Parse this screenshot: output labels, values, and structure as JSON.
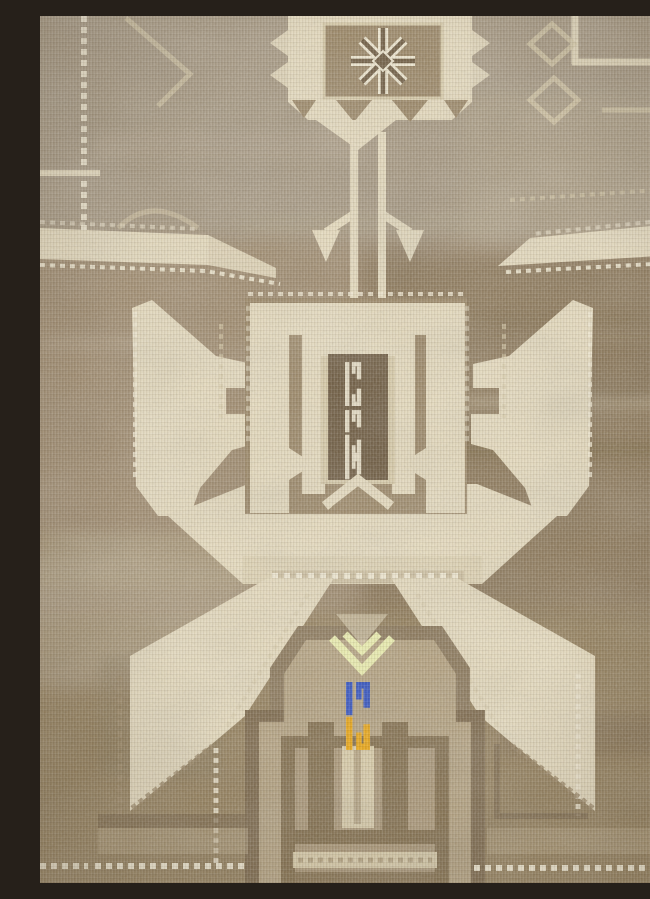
{
  "photo": {
    "type": "photograph",
    "subject": "Vintage hand-knotted Anatolian (Kars) carpet fragment with faded geometric design",
    "alt": "Close-up of a faded beige and brown Anatolian carpet: a square panel with an eight-point snowflake star at top, a pendant stem with two anchor hooks, a large ivory hooked X-shaped medallion with a dark ladder column at center, and a stepped nested-box medallion below with small cobalt-blue, amber and chartreuse knots",
    "visible_text": "none"
  },
  "palette": {
    "field-top": "#a99b84",
    "field-mid": "#a28e71",
    "field-right": "#907c5d",
    "field-bottom": "#97835f",
    "tan-light": "#b9ab90",
    "tan-mid": "#b5a381",
    "tan-mid2": "#ab9878",
    "cream": "#e7dcbe",
    "cream-dim": "#d9cca9",
    "ivory": "#f2ead2",
    "brown-mid": "#9d8968",
    "brown-mid2": "#8d7a5c",
    "brown-dark": "#7e6a4c",
    "brown-dark2": "#84704e",
    "brown-deep": "#6f5c41",
    "accent-blue": "#2d4fc3",
    "accent-gold": "#eca712",
    "accent-chartreuse": "#ecefae"
  },
  "motifs": [
    {
      "id": "top-star-panel",
      "desc": "square panel with dark eight-point snowflake star and sawtooth border, top center"
    },
    {
      "id": "pendant-stem",
      "desc": "double ivory stem descending from star panel with two anchor-like hooks"
    },
    {
      "id": "guard-bands",
      "desc": "cream horizontal guard bands with dotted edges on left and right field"
    },
    {
      "id": "central-medallion",
      "desc": "large ivory hooked medallion shaped like an X with two upper wings and two lower legs"
    },
    {
      "id": "ladder-column",
      "desc": "dark central column holding five small ivory ladder hooks, inside nested cream niches"
    },
    {
      "id": "niche-chevron",
      "desc": "cream chevron closing the central niche"
    },
    {
      "id": "bottom-medallion",
      "desc": "stepped nested-box medallion entering from bottom edge with gabled top"
    },
    {
      "id": "chartreuse-chevron",
      "desc": "pale chartreuse chevron knot at gable center"
    },
    {
      "id": "blue-knot",
      "desc": "small cobalt blue hooked glyph below the chevron"
    },
    {
      "id": "gold-knot",
      "desc": "small amber hooked glyph mirrored beneath the blue one"
    },
    {
      "id": "corner-frames",
      "desc": "partial cream frame lines and diamonds in upper corners"
    }
  ]
}
